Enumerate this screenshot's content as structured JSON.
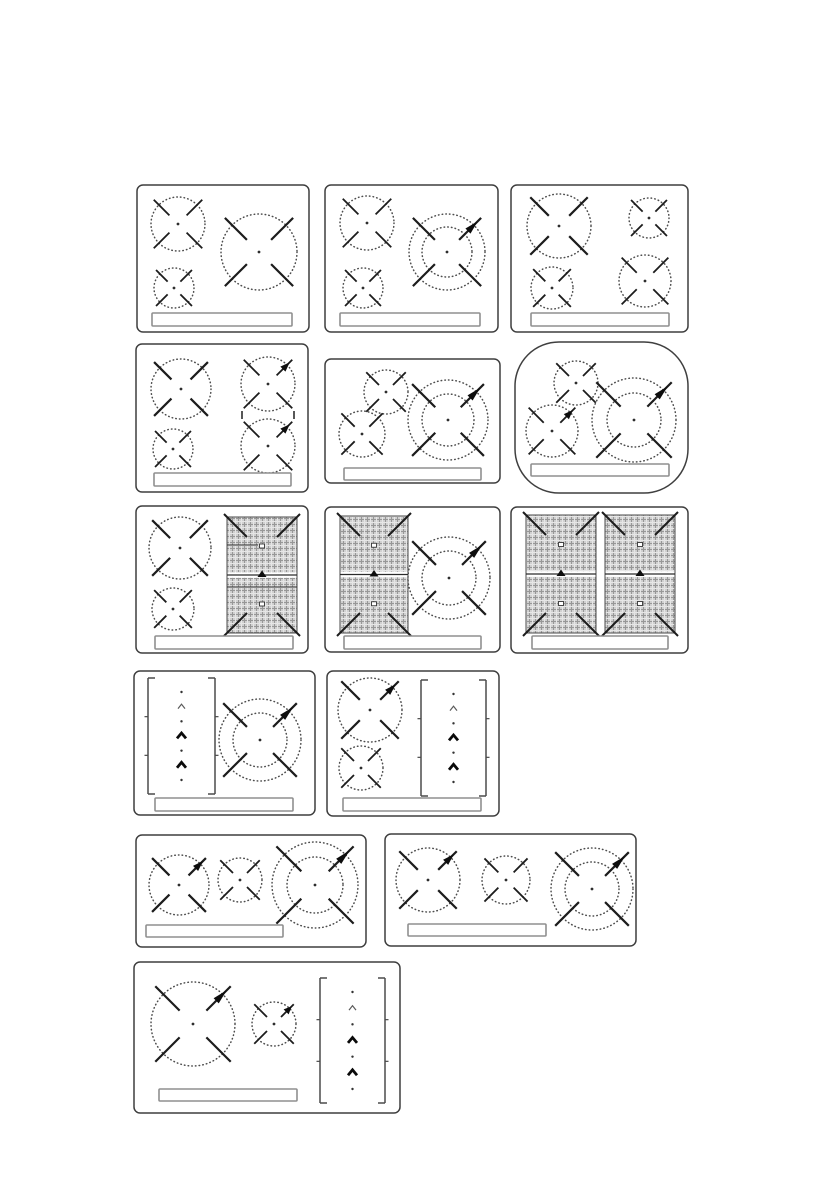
{
  "style": {
    "background": "#ffffff",
    "panel_stroke": "#3f3f3f",
    "ring_dot": "#4d4d4d",
    "arm": "#1c1c1c",
    "center_dot": "#2e2e2e",
    "strip_stroke": "#8f8f8f",
    "hatch_bg": "#d0d0d0",
    "hatch_dark": "#979797",
    "hatch_light": "#e6e6e6",
    "booster_fill": "#0d0d0d",
    "bracket": "#4a4a4a",
    "chevron_bold": "#0a0a0a",
    "chevron_thin": "#5a5a5a",
    "flex_line": "#2a2a2a"
  },
  "panels": [
    {
      "name": "cooktop-3-zone",
      "x": 137,
      "y": 185,
      "w": 172,
      "h": 147,
      "rx": 6,
      "burners": [
        {
          "cx": 41,
          "cy": 39,
          "r": 27
        },
        {
          "cx": 37,
          "cy": 103,
          "r": 20
        },
        {
          "cx": 122,
          "cy": 67,
          "r": 38
        }
      ],
      "strip": {
        "x": 15,
        "y": 128,
        "w": 140,
        "h": 13
      }
    },
    {
      "name": "cooktop-3-zone-double-ring",
      "x": 325,
      "y": 185,
      "w": 173,
      "h": 147,
      "rx": 6,
      "burners": [
        {
          "cx": 42,
          "cy": 38,
          "r": 27
        },
        {
          "cx": 38,
          "cy": 103,
          "r": 20
        },
        {
          "cx": 122,
          "cy": 67,
          "r": 38,
          "inner_r": 25,
          "booster": true
        }
      ],
      "strip": {
        "x": 15,
        "y": 128,
        "w": 140,
        "h": 13
      }
    },
    {
      "name": "cooktop-4-zone",
      "x": 511,
      "y": 185,
      "w": 177,
      "h": 147,
      "rx": 6,
      "burners": [
        {
          "cx": 48,
          "cy": 41,
          "r": 32
        },
        {
          "cx": 138,
          "cy": 33,
          "r": 20
        },
        {
          "cx": 41,
          "cy": 103,
          "r": 21
        },
        {
          "cx": 134,
          "cy": 96,
          "r": 26
        }
      ],
      "strip": {
        "x": 20,
        "y": 128,
        "w": 138,
        "h": 13
      }
    },
    {
      "name": "cooktop-4-zone-bridge",
      "x": 136,
      "y": 344,
      "w": 172,
      "h": 148,
      "rx": 6,
      "burners": [
        {
          "cx": 45,
          "cy": 45,
          "r": 30
        },
        {
          "cx": 37,
          "cy": 105,
          "r": 20
        },
        {
          "cx": 132,
          "cy": 40,
          "r": 27,
          "booster": true
        },
        {
          "cx": 132,
          "cy": 102,
          "r": 27,
          "booster": true
        }
      ],
      "bridge": {
        "x1": 106,
        "x2": 158,
        "y": 71
      },
      "strip": {
        "x": 18,
        "y": 129,
        "w": 137,
        "h": 13
      }
    },
    {
      "name": "cooktop-3-zone-compact",
      "x": 325,
      "y": 359,
      "w": 175,
      "h": 124,
      "rx": 6,
      "burners": [
        {
          "cx": 61,
          "cy": 33,
          "r": 22
        },
        {
          "cx": 37,
          "cy": 75,
          "r": 23
        },
        {
          "cx": 123,
          "cy": 61,
          "r": 40,
          "inner_r": 26,
          "booster": true
        }
      ],
      "strip": {
        "x": 19,
        "y": 109,
        "w": 137,
        "h": 12
      }
    },
    {
      "name": "cooktop-3-zone-rounded",
      "x": 515,
      "y": 342,
      "w": 173,
      "h": 151,
      "rx": 44,
      "burners": [
        {
          "cx": 61,
          "cy": 41,
          "r": 22
        },
        {
          "cx": 37,
          "cy": 89,
          "r": 26,
          "booster": true
        },
        {
          "cx": 119,
          "cy": 78,
          "r": 42,
          "inner_r": 27,
          "booster": true
        }
      ],
      "strip": {
        "x": 16,
        "y": 122,
        "w": 138,
        "h": 12
      }
    },
    {
      "name": "cooktop-2-zone-flex-right",
      "x": 136,
      "y": 506,
      "w": 172,
      "h": 147,
      "rx": 6,
      "burners": [
        {
          "cx": 44,
          "cy": 42,
          "r": 31
        },
        {
          "cx": 37,
          "cy": 103,
          "r": 21
        }
      ],
      "flex_zones": [
        {
          "x": 91,
          "y": 11,
          "w": 70,
          "h": 116,
          "extra_lines": [
            [
              91,
              39,
              122,
              39
            ],
            [
              91,
              81,
              161,
              81
            ]
          ]
        }
      ],
      "strip": {
        "x": 19,
        "y": 130,
        "w": 138,
        "h": 13
      }
    },
    {
      "name": "cooktop-flex-left-double-ring",
      "x": 325,
      "y": 507,
      "w": 175,
      "h": 145,
      "rx": 6,
      "flex_zones": [
        {
          "x": 15,
          "y": 9,
          "w": 68,
          "h": 117
        }
      ],
      "burners": [
        {
          "cx": 124,
          "cy": 71,
          "r": 41,
          "inner_r": 27,
          "booster": true
        }
      ],
      "strip": {
        "x": 19,
        "y": 129,
        "w": 137,
        "h": 13
      }
    },
    {
      "name": "cooktop-double-flex",
      "x": 511,
      "y": 507,
      "w": 177,
      "h": 146,
      "rx": 6,
      "flex_zones": [
        {
          "x": 15,
          "y": 8,
          "w": 70,
          "h": 118
        },
        {
          "x": 94,
          "y": 8,
          "w": 70,
          "h": 118
        }
      ],
      "strip": {
        "x": 21,
        "y": 129,
        "w": 136,
        "h": 13
      }
    },
    {
      "name": "cooktop-slider-left-double-ring",
      "x": 134,
      "y": 671,
      "w": 181,
      "h": 144,
      "rx": 6,
      "bracket_zones": [
        {
          "x": 14,
          "y": 7,
          "w": 67,
          "h": 116,
          "items": [
            "dot",
            "chevron-small",
            "dot",
            "chevron-bold",
            "dot",
            "chevron-bold",
            "dot"
          ]
        }
      ],
      "burners": [
        {
          "cx": 126,
          "cy": 69,
          "r": 41,
          "inner_r": 27,
          "booster": true
        }
      ],
      "strip": {
        "x": 21,
        "y": 127,
        "w": 138,
        "h": 13
      }
    },
    {
      "name": "cooktop-2-zone-slider-right",
      "x": 327,
      "y": 671,
      "w": 172,
      "h": 145,
      "rx": 6,
      "burners": [
        {
          "cx": 43,
          "cy": 39,
          "r": 32,
          "booster": true
        },
        {
          "cx": 34,
          "cy": 97,
          "r": 22
        }
      ],
      "bracket_zones": [
        {
          "x": 94,
          "y": 9,
          "w": 65,
          "h": 116,
          "items": [
            "dot",
            "chevron-small",
            "dot",
            "chevron-bold",
            "dot",
            "chevron-bold",
            "dot"
          ]
        }
      ],
      "strip": {
        "x": 16,
        "y": 127,
        "w": 138,
        "h": 13
      }
    },
    {
      "name": "cooktop-3-zone-inline",
      "x": 136,
      "y": 835,
      "w": 230,
      "h": 112,
      "rx": 6,
      "burners": [
        {
          "cx": 43,
          "cy": 50,
          "r": 30,
          "booster": true
        },
        {
          "cx": 104,
          "cy": 45,
          "r": 22
        },
        {
          "cx": 179,
          "cy": 50,
          "r": 43,
          "inner_r": 28,
          "booster": true
        }
      ],
      "strip": {
        "x": 10,
        "y": 90,
        "w": 137,
        "h": 12
      }
    },
    {
      "name": "cooktop-3-zone-inline-wide",
      "x": 385,
      "y": 834,
      "w": 251,
      "h": 112,
      "rx": 6,
      "burners": [
        {
          "cx": 43,
          "cy": 46,
          "r": 32,
          "booster": true
        },
        {
          "cx": 121,
          "cy": 46,
          "r": 24
        },
        {
          "cx": 207,
          "cy": 55,
          "r": 41,
          "inner_r": 27,
          "booster": true
        }
      ],
      "strip": {
        "x": 23,
        "y": 90,
        "w": 138,
        "h": 12
      }
    },
    {
      "name": "cooktop-2-zone-slider-inline",
      "x": 134,
      "y": 962,
      "w": 266,
      "h": 151,
      "rx": 6,
      "burners": [
        {
          "cx": 59,
          "cy": 62,
          "r": 42,
          "booster": true
        },
        {
          "cx": 140,
          "cy": 62,
          "r": 22,
          "booster": true
        }
      ],
      "bracket_zones": [
        {
          "x": 186,
          "y": 16,
          "w": 65,
          "h": 125,
          "items": [
            "dot",
            "chevron-small",
            "dot",
            "chevron-bold",
            "dot",
            "chevron-bold",
            "dot"
          ]
        }
      ],
      "strip": {
        "x": 25,
        "y": 127,
        "w": 138,
        "h": 12
      }
    }
  ]
}
